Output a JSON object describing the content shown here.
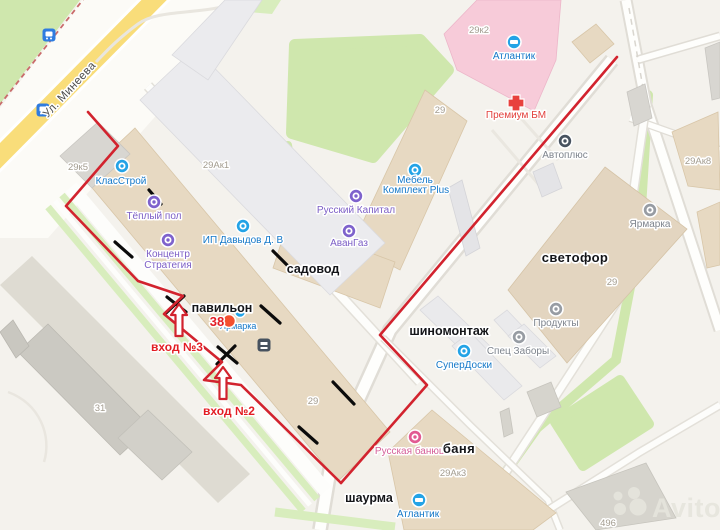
{
  "map": {
    "street": "Ул. Минеева",
    "watermark": "Avito",
    "entrance3": "вход №3",
    "entrance2": "вход №2",
    "pavilion_label": "павильон",
    "pavilion_number": "38",
    "areas": {
      "sadovod": "садовод",
      "shinomontazh": "шиномонтаж",
      "banya": "баня",
      "shaurma": "шаурма",
      "svetofor": "светофор"
    },
    "poi": {
      "klasstroy": "КласСтрой",
      "teply_pol": "Тёплый пол",
      "koncentr_line1": "Концентр",
      "koncentr_line2": "Стратегия",
      "davydov": "ИП Давыдов Д. В",
      "russky_kapital": "Русский Капитал",
      "mebel_line1": "Мебель",
      "mebel_line2": "Комплект Plus",
      "avangaz": "АванГаз",
      "superdoski": "СуперДоски",
      "atlantik_top": "Атлантик",
      "atlantik_bottom": "Атлантик",
      "premium_bm": "Премиум БМ",
      "avtoplus": "Автоплюс",
      "yarmarka_gray": "Ярмарка",
      "produkty": "Продукты",
      "spec_zabory": "Спец Заборы",
      "russkaya_banyushka": "Русская банюшка",
      "yarmarka_blue": "Ярмарка"
    },
    "numbers": {
      "n29k5": "29к5",
      "n29ak1": "29Ак1",
      "n29top": "29",
      "n29k2": "29к2",
      "n29ak8": "29Ак8",
      "n29svet": "29",
      "n29pav": "29",
      "n31": "31",
      "n29ak3": "29Ак3",
      "n496": "496"
    },
    "colors": {
      "route": "#d2232e",
      "pin": "#f4502e",
      "transit": "#2f7ce0",
      "poi_blue": "#23a3e6",
      "poi_purple": "#7e62cc",
      "poi_gray": "#979ca3",
      "poi_pink": "#e25a92",
      "premium_cross": "#e8413d",
      "dark_icon": "#47525f",
      "road_yellow": "#f9dd7a",
      "green": "#cfe7ad",
      "building_beige": "#e7d9c2",
      "watermark_fill": "#e6e5dd"
    }
  }
}
